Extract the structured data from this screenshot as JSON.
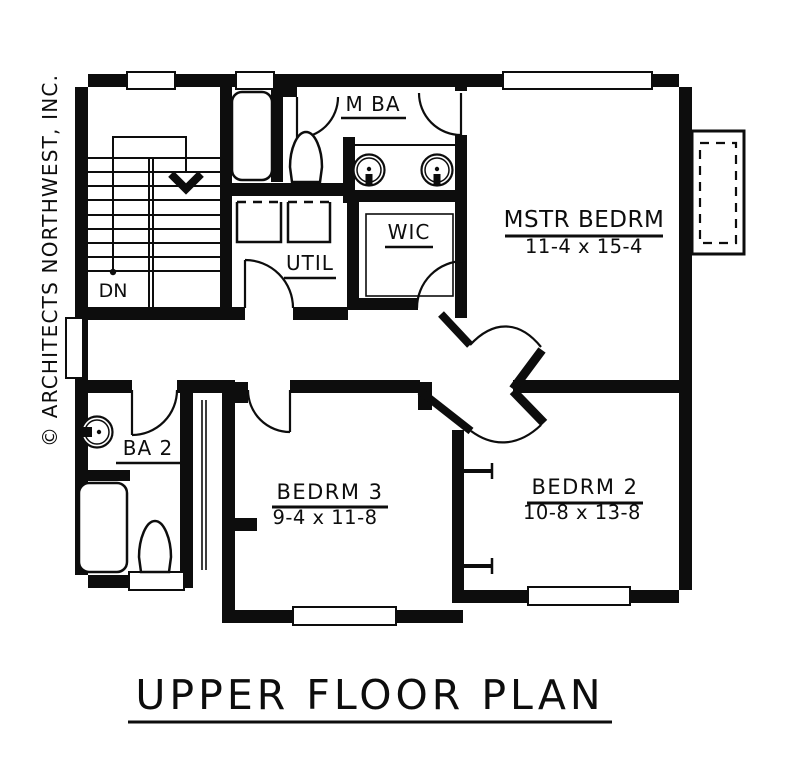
{
  "plan": {
    "title": "UPPER FLOOR PLAN",
    "watermark": "© ARCHITECTS NORTHWEST, INC.",
    "stairs": {
      "label": "DN"
    },
    "rooms": {
      "mstr_bedrm": {
        "label": "MSTR BEDRM",
        "dims": "11-4 x 15-4"
      },
      "m_ba": {
        "label": "M BA"
      },
      "wic": {
        "label": "WIC"
      },
      "util": {
        "label": "UTIL"
      },
      "ba2": {
        "label": "BA 2"
      },
      "bedrm3": {
        "label": "BEDRM 3",
        "dims": "9-4 x 11-8"
      },
      "bedrm2": {
        "label": "BEDRM 2",
        "dims": "10-8 x 13-8"
      }
    },
    "symbols": [
      "bathtub",
      "toilet",
      "sink",
      "washer-dryer",
      "stair-run",
      "down-arrow",
      "door-swing",
      "window",
      "bay-window",
      "closet-shelf"
    ],
    "colors": {
      "ink": "#0d0d0d",
      "paper": "#ffffff"
    }
  }
}
